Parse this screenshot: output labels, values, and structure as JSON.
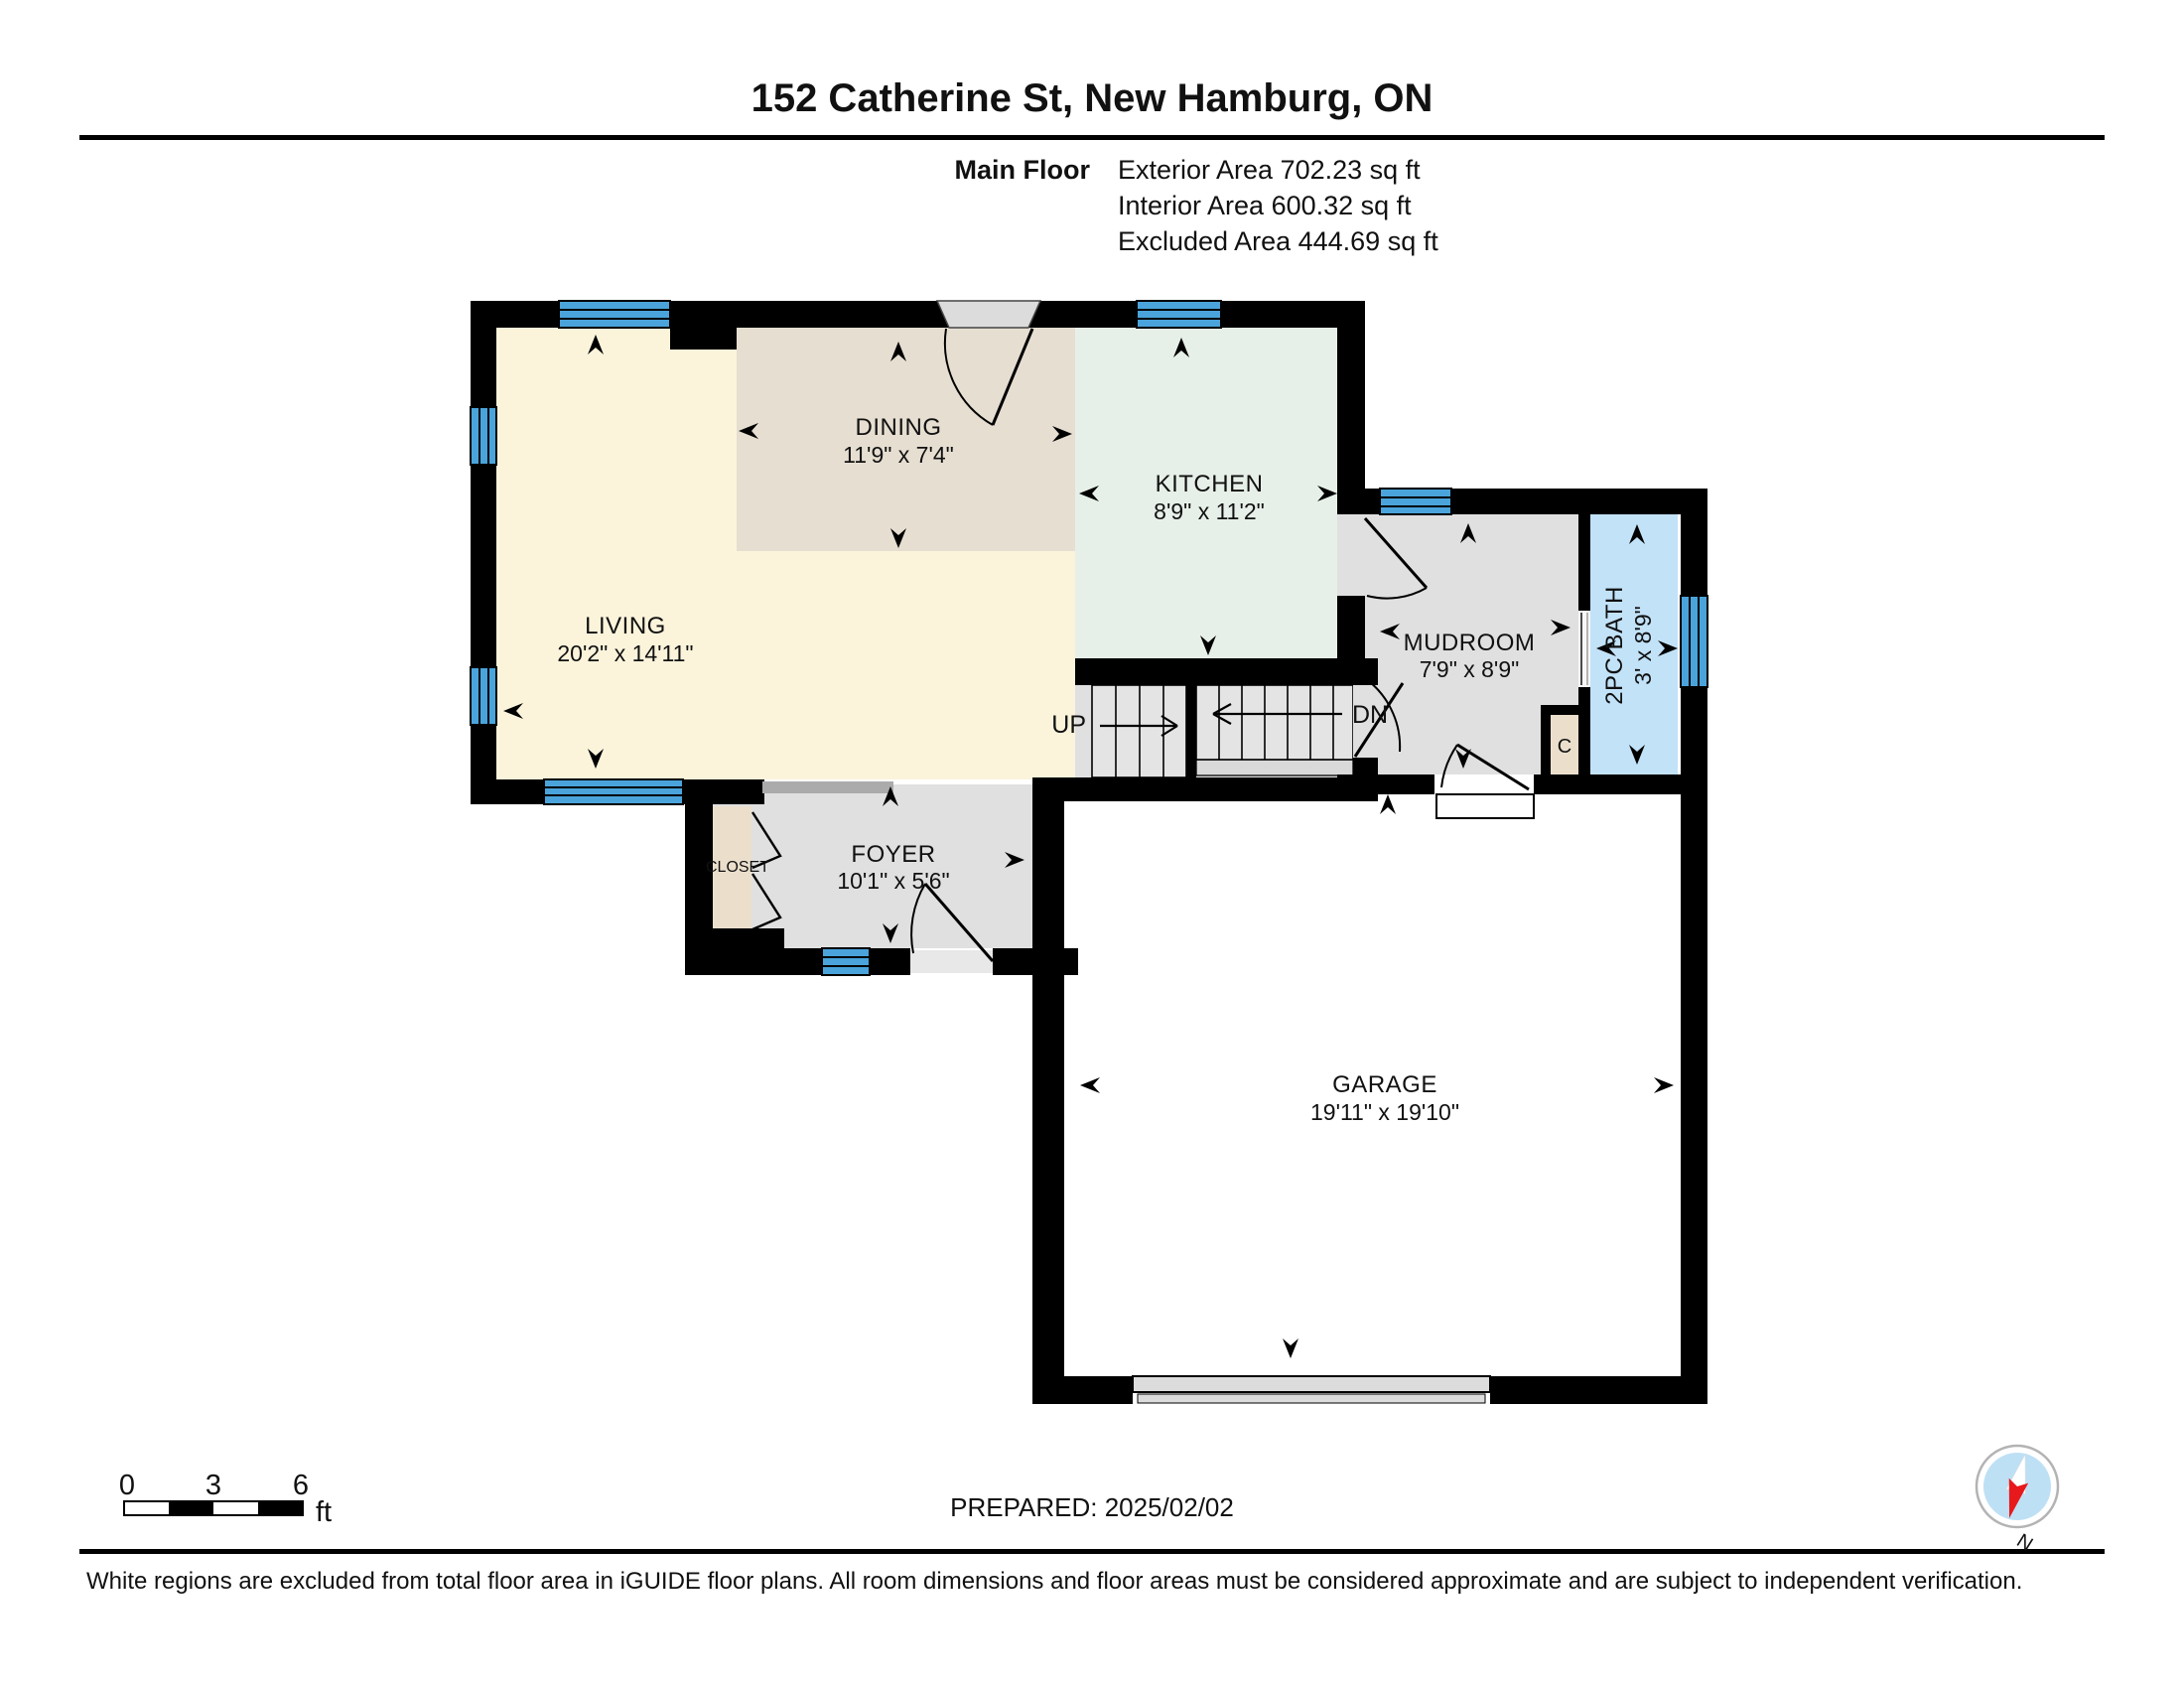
{
  "header": {
    "title": "152 Catherine St, New Hamburg, ON",
    "floor_label": "Main Floor",
    "exterior_area": "Exterior Area 702.23 sq ft",
    "interior_area": "Interior Area 600.32 sq ft",
    "excluded_area": "Excluded Area 444.69 sq ft"
  },
  "rooms": {
    "dining": {
      "name": "DINING",
      "dims": "11'9\" x 7'4\""
    },
    "kitchen": {
      "name": "KITCHEN",
      "dims": "8'9\" x 11'2\""
    },
    "living": {
      "name": "LIVING",
      "dims": "20'2\" x 14'11\""
    },
    "mudroom": {
      "name": "MUDROOM",
      "dims": "7'9\" x 8'9\""
    },
    "bath": {
      "name": "2PC BATH",
      "dims": "3' x 8'9\""
    },
    "foyer": {
      "name": "FOYER",
      "dims": "10'1\" x 5'6\""
    },
    "garage": {
      "name": "GARAGE",
      "dims": "19'11\" x 19'10\""
    },
    "closet": {
      "name": "CLOSET"
    },
    "small_closet": {
      "name": "C"
    }
  },
  "stairs": {
    "up": "UP",
    "down": "DN"
  },
  "scale_bar": {
    "tick0": "0",
    "tick1": "3",
    "tick2": "6",
    "unit": "ft"
  },
  "compass": {
    "north_label": "N"
  },
  "footer": {
    "prepared": "PREPARED: 2025/02/02",
    "disclaimer": "White regions are excluded from total floor area in iGUIDE floor plans. All room dimensions and floor areas must be considered approximate and are subject to independent verification."
  },
  "colors": {
    "wall": "#000000",
    "window_blue": "#4AA4DB",
    "living_fill": "#FBF4DB",
    "dining_fill": "#E6DED1",
    "kitchen_fill": "#E7F0E8",
    "floor_gray": "#E0E0E0",
    "bath_fill": "#C2E2F8",
    "closet_fill": "#EBDFCC",
    "compass_fill": "#BEE0F5",
    "compass_red": "#E8191C"
  }
}
